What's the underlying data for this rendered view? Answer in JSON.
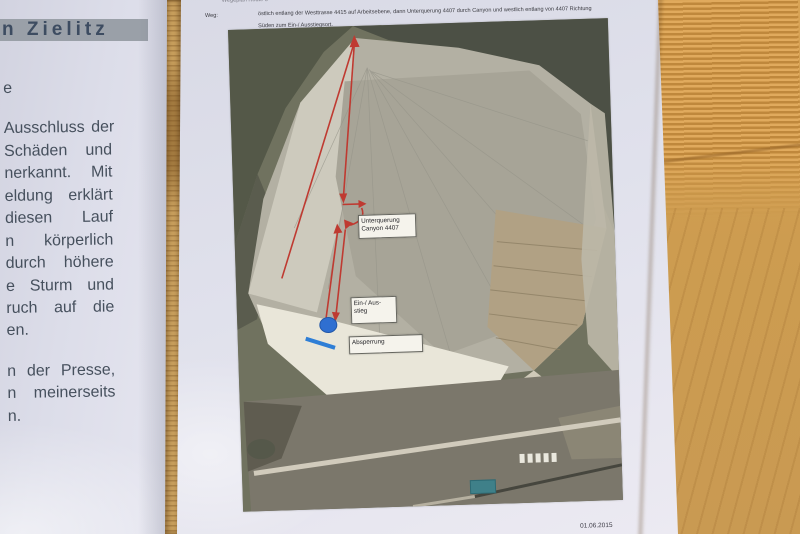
{
  "left_page": {
    "heading": "n Zielitz",
    "fragment_line": "e",
    "paragraph1_lines": [
      "Ausschluss der",
      "Schäden und",
      "nerkannt. Mit",
      "eldung erklärt",
      "diesen Lauf",
      "n körperlich",
      "durch höhere",
      "e Sturm und",
      "ruch auf die",
      "en."
    ],
    "paragraph2_lines": [
      "n der Presse,",
      "n meinerseits",
      "n."
    ],
    "heading_highlight_color": "#9aa0a8"
  },
  "right_page": {
    "top_partial_line": "Wegeplan Route 6",
    "weg_label": "Weg:",
    "weg_line1": "östlich entlang der Westtrasse 4415 auf Arbeitsebene, dann Unterquerung 4407 durch Canyon und westlich entlang von 4407 Richtung",
    "weg_line2": "Süden zum Ein-/ Ausstiegsort.",
    "date": "01.06.2015",
    "photo": {
      "label_unterquerung_line1": "Unterquerung",
      "label_unterquerung_line2": "Canyon 4407",
      "label_einausstieg_line1": "Ein-/ Aus-",
      "label_einausstieg_line2": "stieg",
      "label_absperrung": "Absperrung",
      "route_color": "#bf3a31",
      "marker_color": "#2f6fd1",
      "barrier_color": "#2e7ed6"
    }
  }
}
